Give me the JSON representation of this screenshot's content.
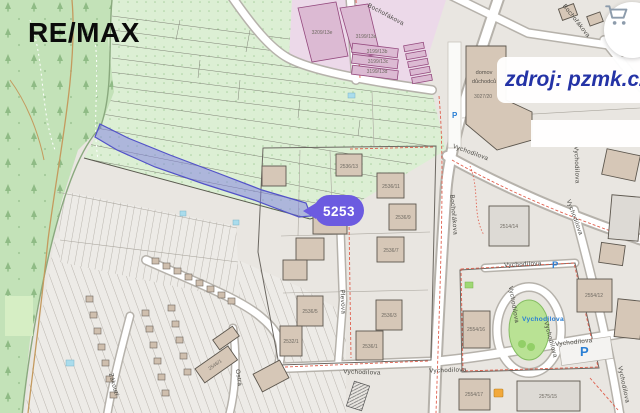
{
  "branding": {
    "logo_text": "RE/MAX"
  },
  "watermark": {
    "source_text": "zdroj: pzmk.cz"
  },
  "marker": {
    "parcel_number": "5253"
  },
  "streets": {
    "bochorakova": "Bochořákova",
    "vychodilova": "Vychodilova",
    "plevova": "Plevova",
    "ostra": "Ostrá",
    "zakouti": "Zákoutí"
  },
  "labels": {
    "parking": "P",
    "retirement_home_line1": "domov",
    "retirement_home_line2": "důchodců",
    "retirement_home_number": "3027/20"
  },
  "buildings": {
    "b3209_13e": "3209/13e",
    "b3199_13a": "3199/13a",
    "b3199_13b": "3199/13b",
    "b3199_13c": "3199/13c",
    "b3199_13d": "3199/13d",
    "b2536_13": "2536/13",
    "b2536_11": "2536/11",
    "b2536_9": "2536/9",
    "b2536_7": "2536/7",
    "b2536_5": "2536/5",
    "b2536_3": "2536/3",
    "b2536_1": "2536/1",
    "b2532_1": "2532/1",
    "b2514_14": "2514/14",
    "b2554_12": "2554/12",
    "b2554_16": "2554/16",
    "b2554_17": "2554/17",
    "b2575_15": "2575/15",
    "b2546_1": "2546/1"
  },
  "colors": {
    "highlight_fill": "#8d8de2",
    "highlight_stroke": "#5252c8",
    "marker_fill": "#6c5be0",
    "watermark_text": "#2433a6",
    "forest_green": "#c3e2b8",
    "orchard_green": "#dcefd4",
    "pink_zone": "#ecd9e9",
    "parking_blue": "#2a7fd4",
    "red_dash": "#e0604e"
  }
}
